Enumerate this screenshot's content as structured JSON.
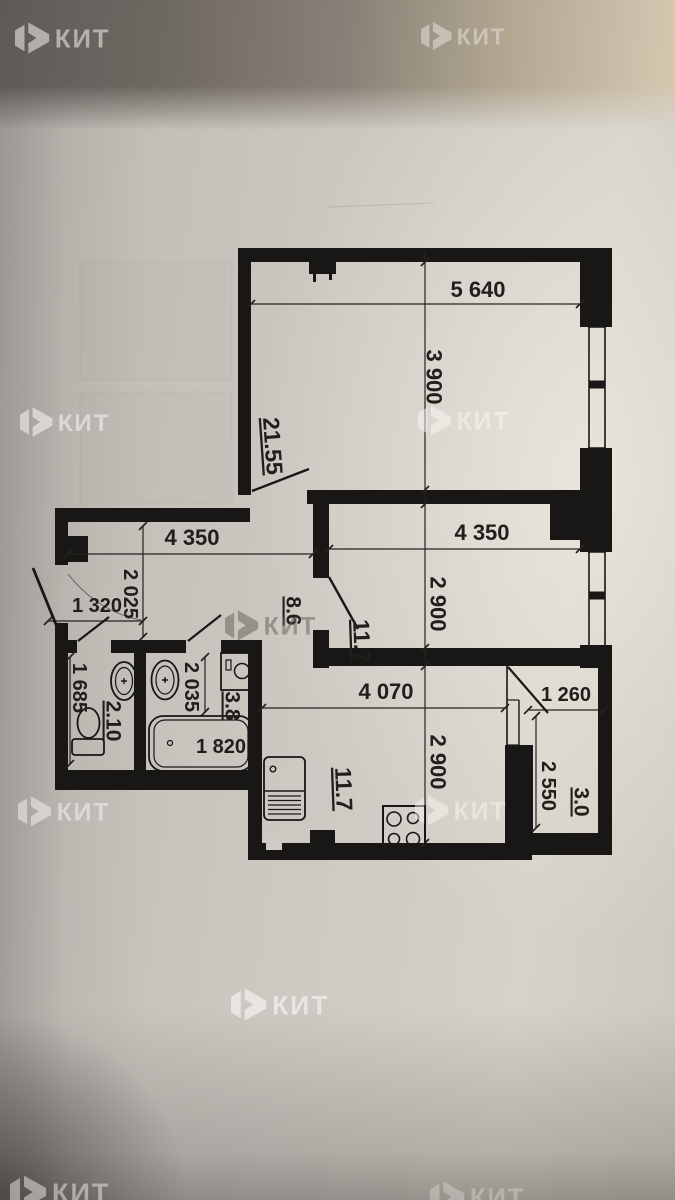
{
  "brand": {
    "name": "КИТ"
  },
  "floor_plan": {
    "areas": {
      "living_room": "21.55",
      "hallway": "8.6",
      "bedroom": "11.7",
      "kitchen": "11.7",
      "wc": "2.10",
      "bathroom": "3.8",
      "balcony": "3.0"
    },
    "dimensions": {
      "living_width": "5 640",
      "living_depth": "3 900",
      "hallway_width": "4 350",
      "hallway_depth": "2 025",
      "entry_width": "1 320",
      "bedroom_width": "4 350",
      "bedroom_depth": "2 900",
      "kitchen_width": "4 070",
      "kitchen_depth": "2 900",
      "wc_depth": "1 685",
      "bathroom_depth": "2 035",
      "bathtub_length": "1 820",
      "balcony_width": "1 260",
      "balcony_depth": "2 550"
    }
  }
}
